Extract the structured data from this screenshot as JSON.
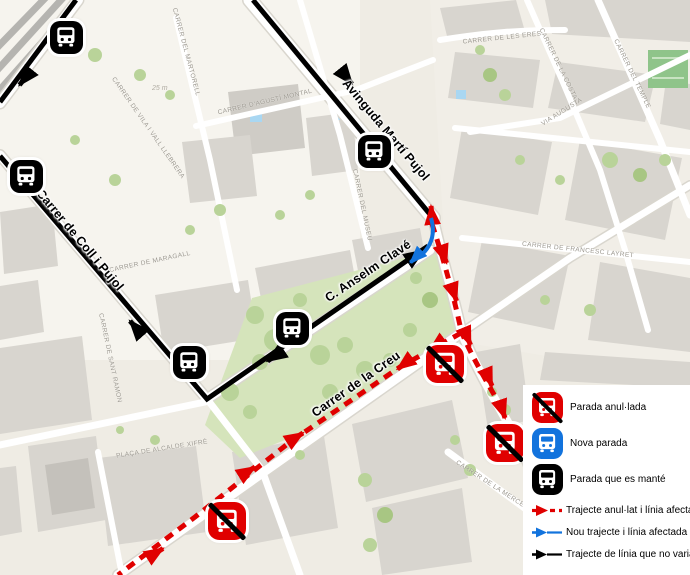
{
  "legend": {
    "items": [
      {
        "label": "Parada anul·lada",
        "type": "stop-cancelled"
      },
      {
        "label": "Nova parada",
        "type": "stop-new"
      },
      {
        "label": "Parada que es manté",
        "type": "stop-kept"
      },
      {
        "label": "Trajecte anul·lat i línia afectada",
        "type": "line-cancelled"
      },
      {
        "label": "Nou trajecte i línia afectada",
        "type": "line-new"
      },
      {
        "label": "Trajecte de línia que no varia",
        "type": "line-unchanged"
      }
    ]
  },
  "map": {
    "major_streets": [
      {
        "text": "Avinguda Martí Pujol"
      },
      {
        "text": "Carrer de Coll i Pujol"
      },
      {
        "text": "C. Anselm Clavé"
      },
      {
        "text": "Carrer de la Creu"
      }
    ],
    "minor_streets": [
      {
        "text": "CARRER DE MARAGALL"
      },
      {
        "text": "CARRER DE VILA I VALL LLEBRERA"
      },
      {
        "text": "CARRER DEL MARTORELL"
      },
      {
        "text": "CARRER D'AGUSTÍ MONTAL"
      },
      {
        "text": "CARRER DEL MUSEU"
      },
      {
        "text": "CARRER DE SANT RAMON"
      },
      {
        "text": "CARRER DE LES ERES"
      },
      {
        "text": "CARRER DE LA COSTA"
      },
      {
        "text": "CARRER DEL TEMPLE"
      },
      {
        "text": "VIA AUGUSTA"
      },
      {
        "text": "PLAÇA DE ALCALDE XIFRÉ"
      },
      {
        "text": "CARRER DE LA MERCÈ"
      },
      {
        "text": "CARRER DE FRANCESC LAYRET"
      }
    ],
    "scale_text": "25 m",
    "colors": {
      "route_unchanged": "#000000",
      "route_cancelled": "#e00000",
      "route_new": "#1273dd",
      "buildings": "#d8d5cf",
      "park": "#d5e4bb",
      "background": "#efece4"
    }
  }
}
